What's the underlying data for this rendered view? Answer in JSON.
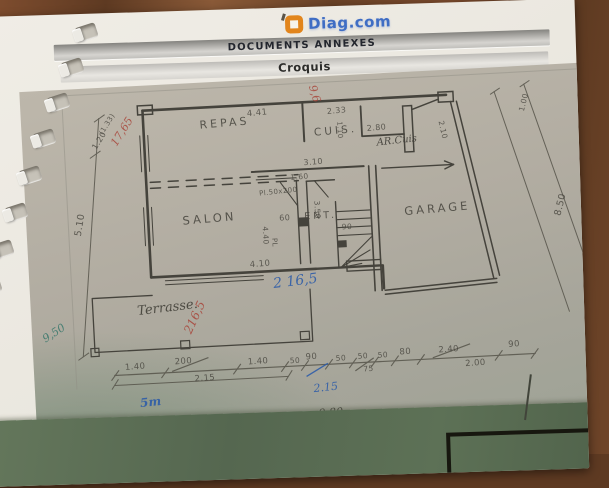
{
  "header": {
    "logo": {
      "text": "Diag.com",
      "accent_color": "#e2851c",
      "text_color": "#3f6dc4"
    },
    "bar1": "DOCUMENTS ANNEXES",
    "bar2": "Croquis"
  },
  "plan": {
    "title": "Croquis",
    "ink_color": "#45433c",
    "red_ink": "#a8453a",
    "blue_ink": "#2f5da8",
    "teal_ink": "#3e7a6e",
    "rooms": [
      "REPAS",
      "CUIS.",
      "AR.Cuis",
      "SALON",
      "ENT.",
      "GARAGE",
      "Terrasse."
    ],
    "annotations": [
      {
        "name": "room-label-repas",
        "text": "REPAS",
        "x": 156,
        "y": 36,
        "rot": -2,
        "size": 11,
        "cls": "room"
      },
      {
        "name": "room-label-cuisine",
        "text": "CUIS.",
        "x": 270,
        "y": 50,
        "rot": -2,
        "size": 10.5,
        "cls": "room"
      },
      {
        "name": "room-label-arriere-cuisine",
        "text": "AR.Cuis",
        "x": 332,
        "y": 64,
        "rot": -3,
        "size": 10,
        "cls": "hand"
      },
      {
        "name": "room-label-salon",
        "text": "SALON",
        "x": 134,
        "y": 130,
        "rot": -2,
        "size": 11.5,
        "cls": "room"
      },
      {
        "name": "room-label-entree",
        "text": "ENT.",
        "x": 256,
        "y": 134,
        "rot": 0,
        "size": 9.5,
        "cls": "room"
      },
      {
        "name": "room-label-garage",
        "text": "GARAGE",
        "x": 356,
        "y": 132,
        "rot": -2,
        "size": 11.5,
        "cls": "room"
      },
      {
        "name": "room-label-terrasse",
        "text": "Terrasse.",
        "x": 84,
        "y": 218,
        "rot": -4,
        "size": 13,
        "cls": "hand"
      },
      {
        "name": "dim-4-41",
        "text": "4.41",
        "x": 204,
        "y": 29,
        "rot": -2,
        "size": 8.5,
        "cls": "dim"
      },
      {
        "name": "dim-2-33",
        "text": "2.33",
        "x": 284,
        "y": 31,
        "rot": -2,
        "size": 8,
        "cls": "dim"
      },
      {
        "name": "dim-2-80",
        "text": "2.80",
        "x": 323,
        "y": 50,
        "rot": -2,
        "size": 8,
        "cls": "dim"
      },
      {
        "name": "dim-1-10",
        "text": "1.10",
        "x": 300,
        "y": 46,
        "rot": 90,
        "size": 7,
        "cls": "dim"
      },
      {
        "name": "dim-2-10",
        "text": "2.10",
        "x": 402,
        "y": 50,
        "rot": 80,
        "size": 7.5,
        "cls": "dim"
      },
      {
        "name": "dim-1-00",
        "text": "1.00",
        "x": 474,
        "y": 44,
        "rot": -73,
        "size": 7.5,
        "cls": "dim"
      },
      {
        "name": "dim-1-20",
        "text": "1.20",
        "x": 46,
        "y": 58,
        "rot": -55,
        "size": 8,
        "cls": "dim"
      },
      {
        "name": "dim-1-33",
        "text": "(1.33)",
        "x": 54,
        "y": 44,
        "rot": -55,
        "size": 7,
        "cls": "dim"
      },
      {
        "name": "dim-5-10",
        "text": "5.10",
        "x": 24,
        "y": 146,
        "rot": -78,
        "size": 9.5,
        "cls": "dim"
      },
      {
        "name": "dim-8-50",
        "text": "8.50",
        "x": 504,
        "y": 150,
        "rot": -73,
        "size": 9.5,
        "cls": "dim"
      },
      {
        "name": "dim-9-50",
        "text": "9.50",
        "x": 534,
        "y": 146,
        "rot": -73,
        "size": 9.5,
        "cls": "dim"
      },
      {
        "name": "dim-3-10",
        "text": "3.10",
        "x": 258,
        "y": 81,
        "rot": -2,
        "size": 8,
        "cls": "dim"
      },
      {
        "name": "dim-1-60",
        "text": "1.60",
        "x": 244,
        "y": 95,
        "rot": -2,
        "size": 7.5,
        "cls": "dim"
      },
      {
        "name": "dim-placard-50x200",
        "text": "Pl.50x200",
        "x": 212,
        "y": 110,
        "rot": -3,
        "size": 7,
        "cls": "dim"
      },
      {
        "name": "dim-3-50",
        "text": "3.50",
        "x": 274,
        "y": 124,
        "rot": 90,
        "size": 7.5,
        "cls": "dim"
      },
      {
        "name": "dim-90-stairs",
        "text": "90",
        "x": 293,
        "y": 147,
        "rot": 0,
        "size": 7.5,
        "cls": "dim"
      },
      {
        "name": "dim-60",
        "text": "60",
        "x": 231,
        "y": 135,
        "rot": 0,
        "size": 8,
        "cls": "dim"
      },
      {
        "name": "dim-4-40",
        "text": "4.40",
        "x": 221,
        "y": 147,
        "rot": 90,
        "size": 7.5,
        "cls": "dim"
      },
      {
        "name": "dim-pl",
        "text": "PL",
        "x": 229,
        "y": 159,
        "rot": 90,
        "size": 7,
        "cls": "dim"
      },
      {
        "name": "dim-4-10",
        "text": "4.10",
        "x": 199,
        "y": 180,
        "rot": -2,
        "size": 8.5,
        "cls": "dim"
      },
      {
        "name": "hand-17-65",
        "text": "17,65",
        "x": 64,
        "y": 54,
        "rot": -55,
        "size": 11,
        "cls": "red-hand"
      },
      {
        "name": "hand-9-6",
        "text": "9,6",
        "x": 277,
        "y": 7,
        "rot": 76,
        "size": 11,
        "cls": "red-hand"
      },
      {
        "name": "hand-216-5-red",
        "text": "216,5",
        "x": 127,
        "y": 246,
        "rot": -62,
        "size": 12,
        "cls": "red-hand"
      },
      {
        "name": "hand-216-5-blue",
        "text": "2 16,5",
        "x": 221,
        "y": 197,
        "rot": -4,
        "size": 14,
        "cls": "blue-hand"
      },
      {
        "name": "chain-1-40-a",
        "text": "1.40",
        "x": 69,
        "y": 276,
        "rot": -1,
        "size": 8.5,
        "cls": "dim"
      },
      {
        "name": "chain-200",
        "text": "200",
        "x": 119,
        "y": 273,
        "rot": -1,
        "size": 8.5,
        "cls": "dim"
      },
      {
        "name": "chain-2-15",
        "text": "2.15",
        "x": 138,
        "y": 291,
        "rot": -1,
        "size": 8.5,
        "cls": "dim"
      },
      {
        "name": "chain-1-40-b",
        "text": "1.40",
        "x": 192,
        "y": 277,
        "rot": -1,
        "size": 8.5,
        "cls": "dim"
      },
      {
        "name": "chain-50-a",
        "text": "50",
        "x": 234,
        "y": 278,
        "rot": -1,
        "size": 7.5,
        "cls": "dim"
      },
      {
        "name": "chain-90-a",
        "text": "90",
        "x": 250,
        "y": 275,
        "rot": -1,
        "size": 8.5,
        "cls": "dim"
      },
      {
        "name": "chain-50-b",
        "text": "50",
        "x": 280,
        "y": 278,
        "rot": -1,
        "size": 7.5,
        "cls": "dim"
      },
      {
        "name": "chain-50-c",
        "text": "50",
        "x": 302,
        "y": 277,
        "rot": -1,
        "size": 7.5,
        "cls": "dim"
      },
      {
        "name": "chain-75",
        "text": "75",
        "x": 307,
        "y": 290,
        "rot": -1,
        "size": 7.5,
        "cls": "dim"
      },
      {
        "name": "chain-50-d",
        "text": "50",
        "x": 322,
        "y": 277,
        "rot": -1,
        "size": 7.5,
        "cls": "dim"
      },
      {
        "name": "chain-80",
        "text": "80",
        "x": 344,
        "y": 275,
        "rot": -1,
        "size": 8.5,
        "cls": "dim"
      },
      {
        "name": "chain-2-40",
        "text": "2.40",
        "x": 383,
        "y": 275,
        "rot": -1,
        "size": 8.5,
        "cls": "dim"
      },
      {
        "name": "chain-2-00",
        "text": "2.00",
        "x": 409,
        "y": 290,
        "rot": -1,
        "size": 8.5,
        "cls": "dim"
      },
      {
        "name": "chain-90-b",
        "text": "90",
        "x": 453,
        "y": 273,
        "rot": -1,
        "size": 8.5,
        "cls": "dim"
      },
      {
        "name": "hand-2-15-blue",
        "text": "2.15",
        "x": 256,
        "y": 305,
        "rot": -3,
        "size": 11,
        "cls": "blue-hand"
      },
      {
        "name": "hand-5m",
        "text": "5m",
        "x": 82,
        "y": 310,
        "rot": -3,
        "size": 12,
        "cls": "blue-hand bold"
      },
      {
        "name": "hand-9-50",
        "text": "9,50",
        "x": -14,
        "y": 243,
        "rot": -30,
        "size": 11,
        "cls": "teal-hand"
      },
      {
        "name": "hand-4-80",
        "text": "4.80",
        "x": 120,
        "y": 330,
        "rot": -1,
        "size": 11,
        "cls": "hand"
      },
      {
        "name": "hand-9-80",
        "text": "9.80",
        "x": 260,
        "y": 330,
        "rot": -1,
        "size": 11,
        "cls": "hand"
      }
    ]
  }
}
